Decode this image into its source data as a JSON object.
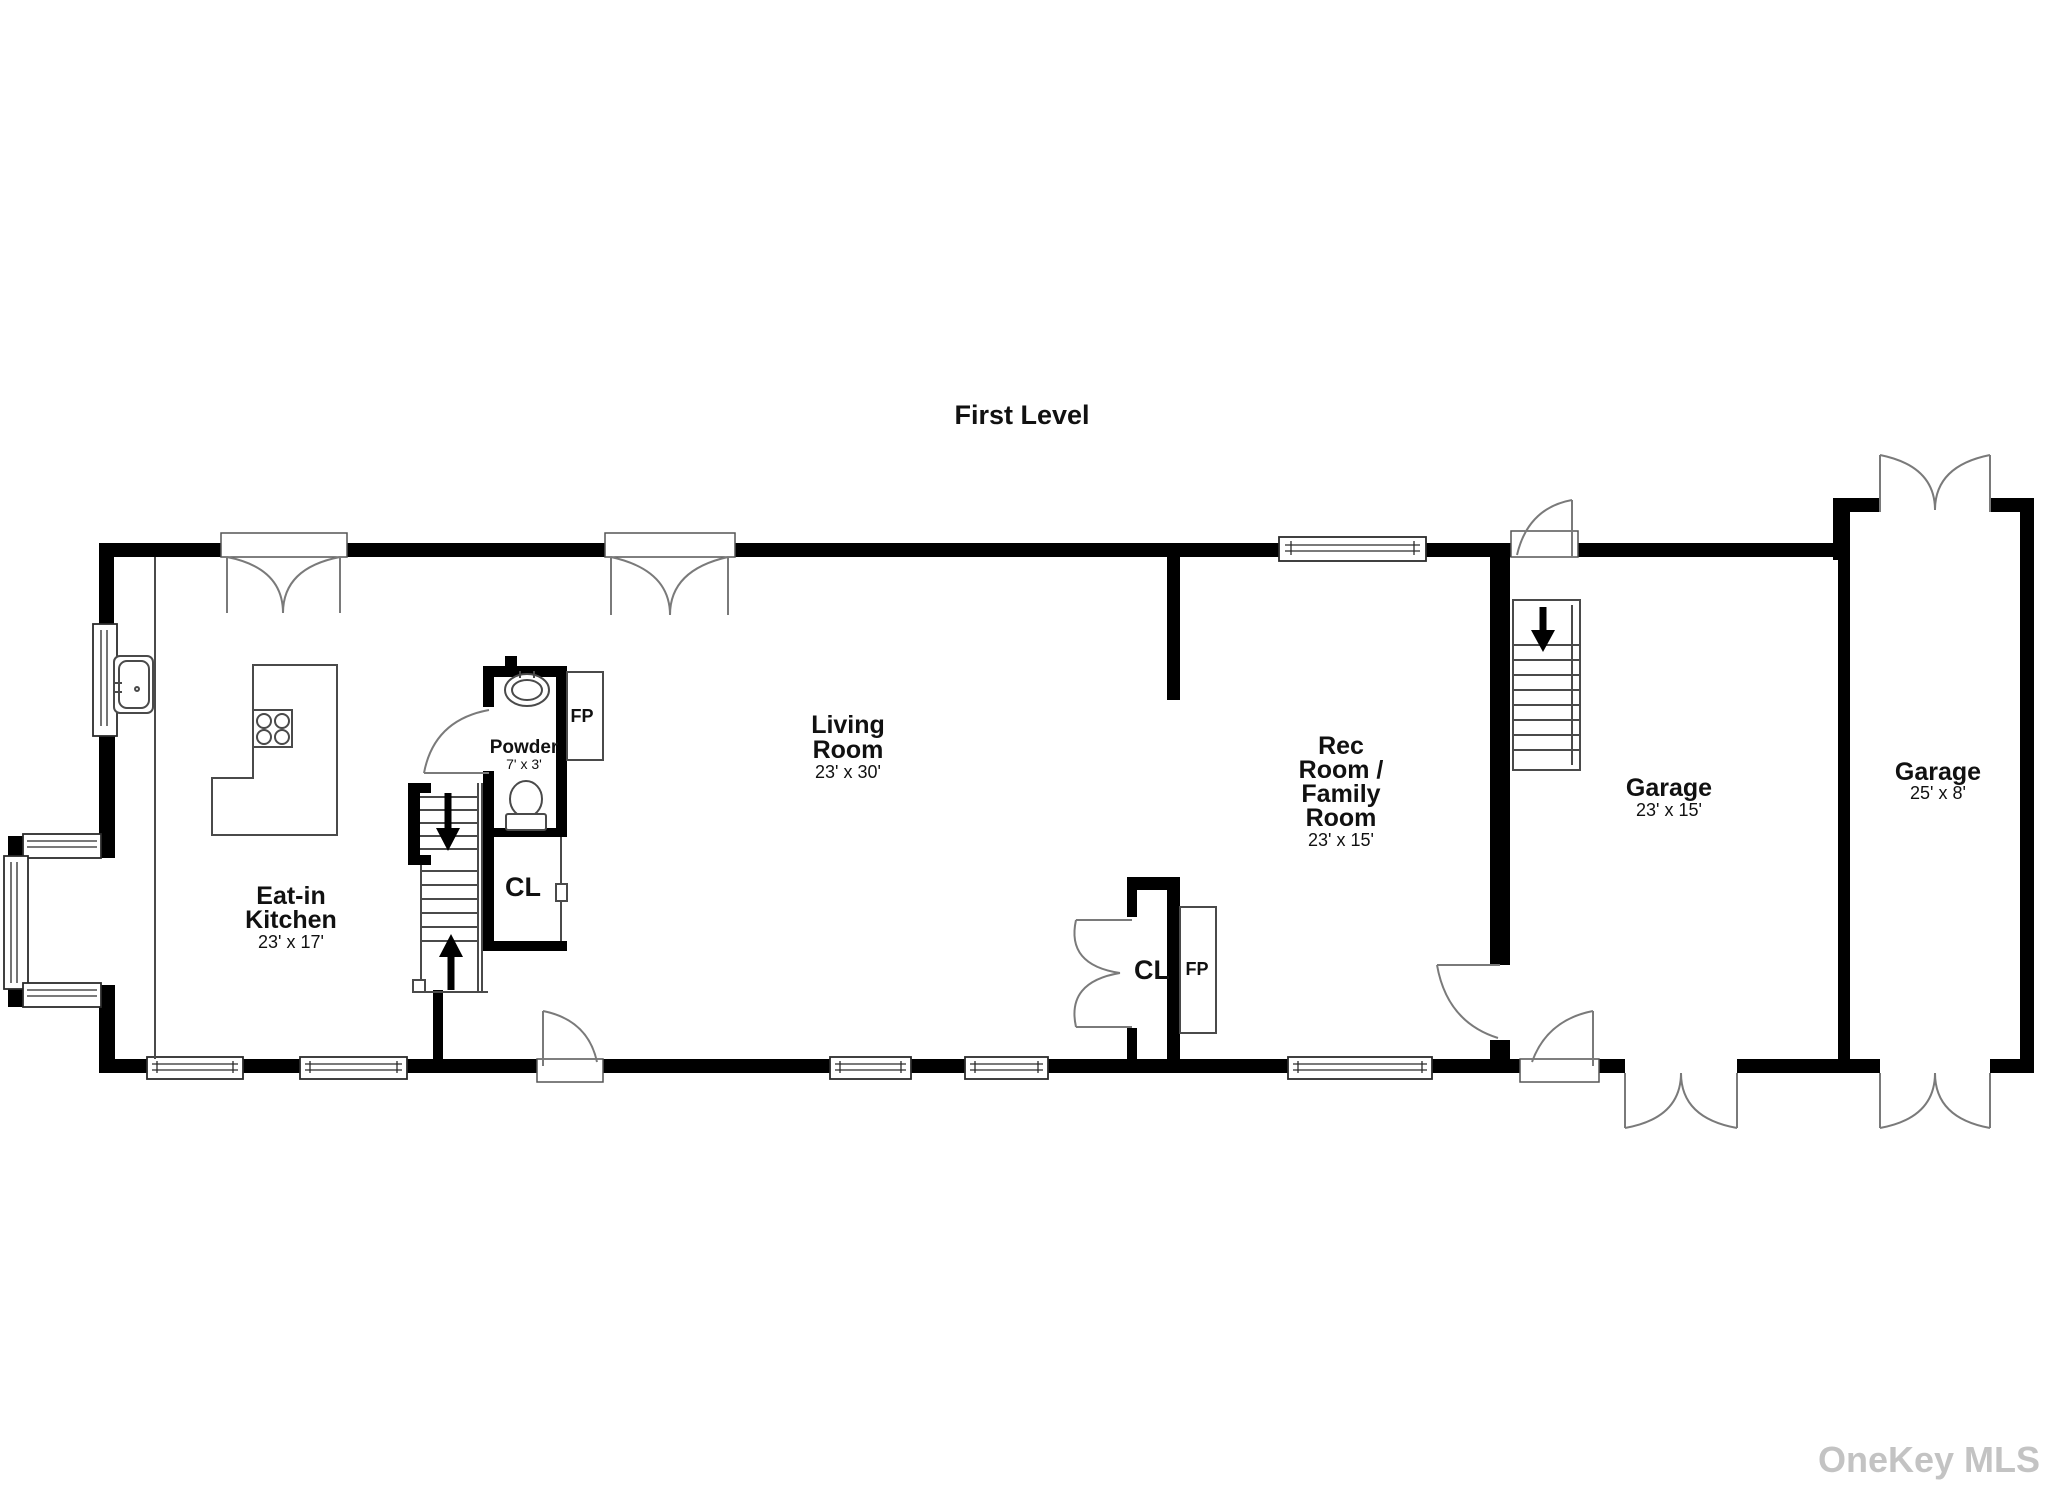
{
  "title": "First Level",
  "watermark": "OneKey MLS",
  "rooms": {
    "kitchen": {
      "name1": "Eat-in",
      "name2": "Kitchen",
      "dims": "23' x 17'"
    },
    "living": {
      "name1": "Living",
      "name2": "Room",
      "dims": "23' x 30'"
    },
    "rec": {
      "name1": "Rec",
      "name2": "Room /",
      "name3": "Family",
      "name4": "Room",
      "dims": "23' x 15'"
    },
    "garage_left": {
      "name1": "Garage",
      "dims": "23' x 15'"
    },
    "garage_right": {
      "name1": "Garage",
      "dims": "25' x 8'"
    },
    "powder": {
      "name1": "Powder",
      "dims": "7' x 3'"
    }
  },
  "labels": {
    "closet_hall": "CL",
    "closet_rec": "CL",
    "fireplace_powder": "FP",
    "fireplace_rec": "FP"
  },
  "colors": {
    "wall": "#000000",
    "text": "#111111",
    "watermark": "#c3c3c3",
    "background": "#ffffff"
  }
}
